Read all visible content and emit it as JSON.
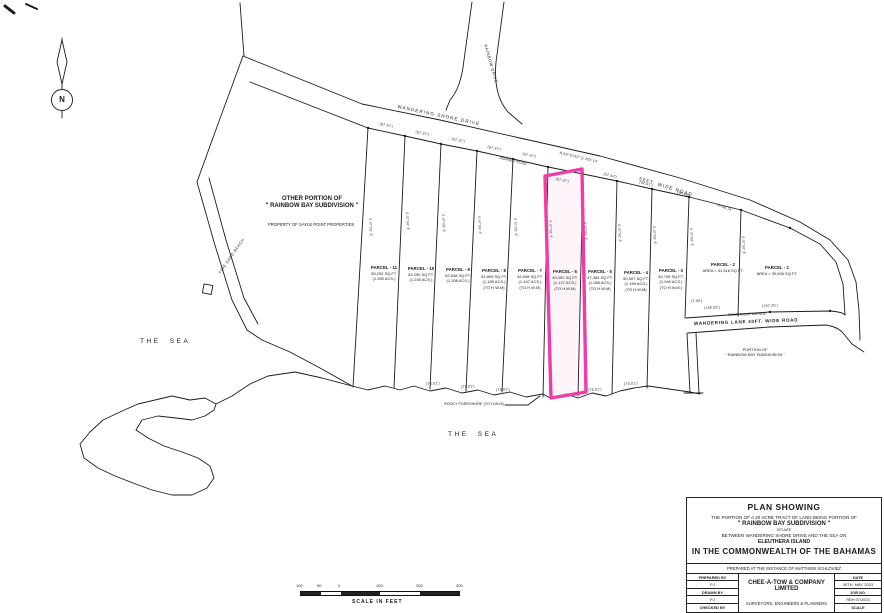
{
  "compass": {
    "n": "N"
  },
  "roads": {
    "wandering_shore_drive": "WANDERING SHORE DRIVE",
    "asphalt_road": "ASPHALT ROAD",
    "fifty_ft_wide_road": "50FT. WIDE ROAD",
    "rainbow_drive": "RAINBOW DRIVE",
    "wandering_lane": "WANDERING LANE 40FT. WIDE ROAD",
    "southwest_avenue": "SOUTHWEST AVENUE",
    "road_bearing": "N 63°10'52\" E  259.14'"
  },
  "regions": {
    "other_portion_1": "OTHER PORTION OF",
    "other_portion_2": "\" RAINBOW BAY SUBDIVISION \"",
    "property_of": "PROPERTY OF SAYLE POINT PROPERTIES",
    "portion_of_1": "PORTION OF",
    "portion_of_2": "\" RAINBOW BAY SUBDIVISION \"",
    "sea": "THE SEA",
    "beach": "FINE SAND BEACH",
    "foreshore": "ROCKY FORESHORE (TO H.W.M)"
  },
  "parcels": [
    {
      "name": "PARCEL - 11",
      "area": "55,292 SQ.FT.",
      "acres": "(1.269 ACS.)",
      "hwm": ""
    },
    {
      "name": "PARCEL - 10",
      "area": "54,250 SQ.FT.",
      "acres": "(1.245 ACS.)",
      "hwm": ""
    },
    {
      "name": "PARCEL - 9",
      "area": "52,548 SQ.FT.",
      "acres": "(1.206 ACS.)",
      "hwm": ""
    },
    {
      "name": "PARCEL - 8",
      "area": "51,809 SQ.FT.",
      "acres": "(1.189 ACS.)",
      "hwm": "(TO H.W.M)"
    },
    {
      "name": "PARCEL - 7",
      "area": "49,948 SQ.FT.",
      "acres": "(1.147 ACS.)",
      "hwm": "(TO H.W.M)"
    },
    {
      "name": "PARCEL - 6",
      "area": "49,092 SQ.FT.",
      "acres": "(1.127 ACS.)",
      "hwm": "(TO H.W.M)"
    },
    {
      "name": "PARCEL - 5",
      "area": "47,384 SQ.FT.",
      "acres": "(1.088 ACS.)",
      "hwm": "(TO H.W.M)"
    },
    {
      "name": "PARCEL - 4",
      "area": "50,507 SQ.FT.",
      "acres": "(1.159 ACS.)",
      "hwm": "(TO H.W.M)"
    },
    {
      "name": "PARCEL - 3",
      "area": "45,705 SQ.FT.",
      "acres": "(1.049 ACS.)",
      "hwm": "(TO H.W.M.)"
    },
    {
      "name": "PARCEL - 2",
      "area": "AREA = 41,316 SQ.FT.",
      "acres": "",
      "hwm": ""
    },
    {
      "name": "PARCEL - 1",
      "area": "AREA = 30,506 SQ.FT.",
      "acres": "",
      "hwm": ""
    }
  ],
  "dims": {
    "d5737": "(57.37')",
    "d5743": "(57.43')",
    "d6251": "(62.51')",
    "d6405": "(64.05')",
    "a5874": "A=58.74'",
    "d7501": "(75.01')",
    "d10500": "(105.00')",
    "d15725": "(157.25')",
    "d709": "(7.09')",
    "bearing": "S 07°08' E"
  },
  "scale_bar": {
    "labels": [
      "100",
      "50",
      "0",
      "100",
      "200",
      "300"
    ],
    "caption": "SCALE IN FEET"
  },
  "title_block": {
    "line1": "PLAN SHOWING",
    "line2": "THE PORTION OF A 20 ACRE TRACT OF LAND BEING PORTION OF",
    "line3": "\" RAINBOW BAY SUBDIVISION \"",
    "line4": "SITUATE",
    "line5": "BETWEEN WANDERING SHORE DRIVE AND THE SEA ON",
    "line6": "ELEUTHERA  ISLAND",
    "line7": "IN THE COMMONWEALTH OF THE BAHAMAS",
    "prepared_instance": "PREPARED AT THE INSTANCE OF MATTHEW SCHLOVIEZ",
    "prepared_by_label": "PREPARED BY",
    "prepared_by": "P.J",
    "drawn_by_label": "DRAWN BY",
    "drawn_by": "P.J",
    "checked_by_label": "CHECKED BY",
    "company": "CHEE-A-TOW & COMPANY LIMITED",
    "company_sub": "SURVEYORS, ENGINEERS & PLANNERS",
    "date_label": "DATE",
    "date_value": "30TH, MAY, 2023",
    "job_label": "JOB NO.",
    "job_value": "RBH 07/2023",
    "scale_label": "SCALE",
    "scale_value": ""
  },
  "colors": {
    "highlight": "#ee3ea6",
    "ink": "#1b1b1b"
  }
}
